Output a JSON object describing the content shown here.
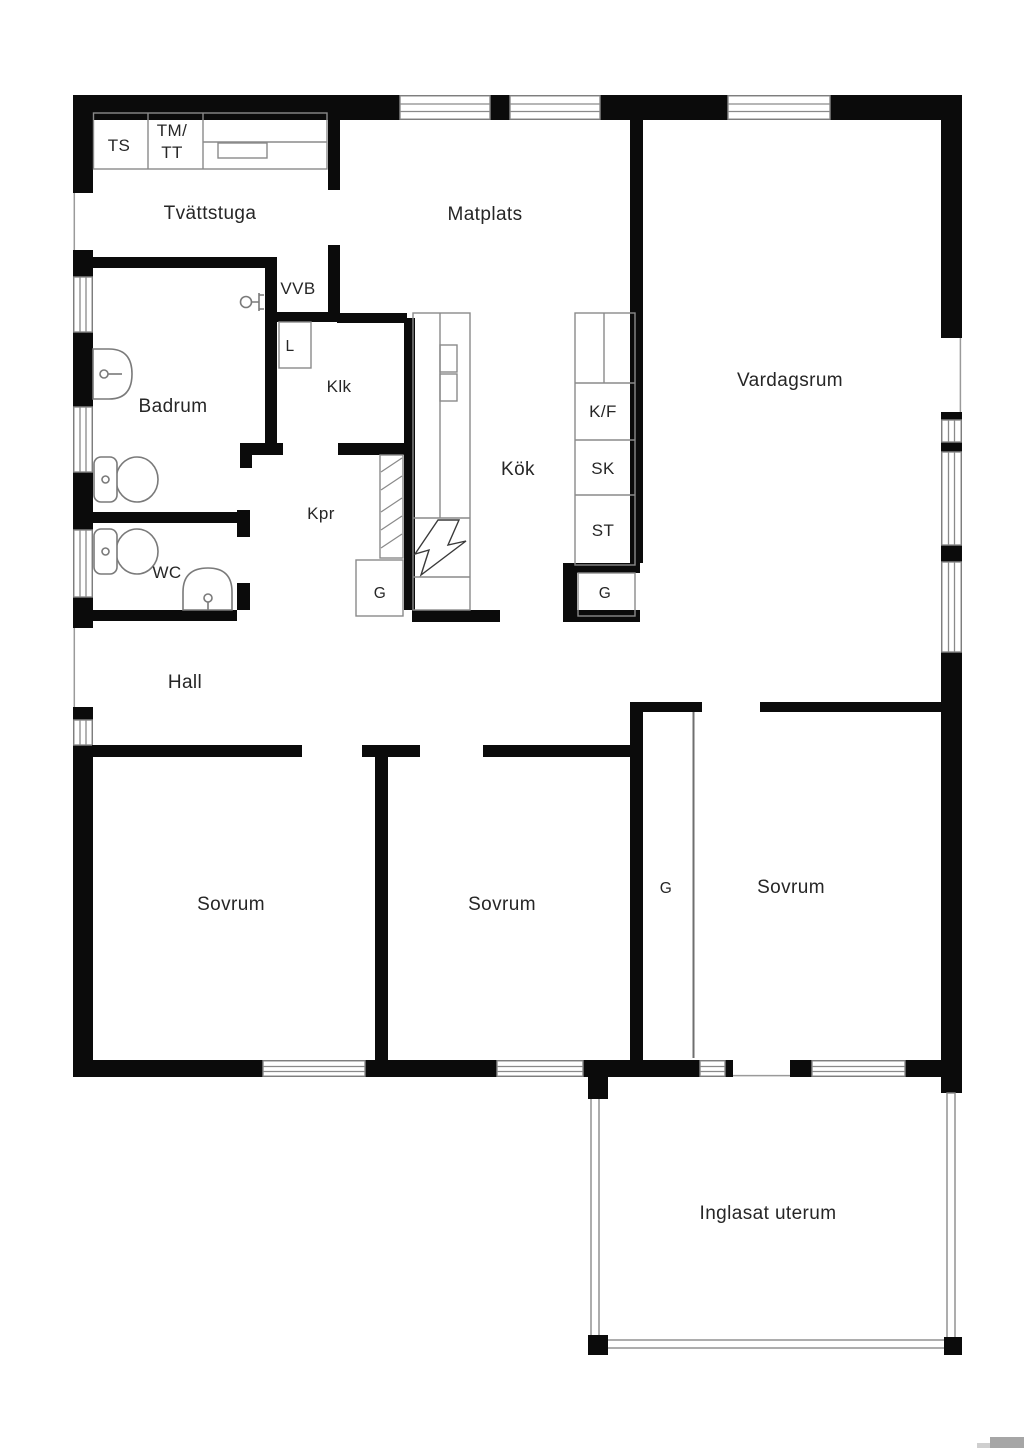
{
  "document": {
    "type": "floor-plan",
    "language": "sv",
    "background": "#ffffff"
  },
  "colors": {
    "wall": "#0b0b0b",
    "thin_line": "#8a8a8a",
    "text": "#262626",
    "watermark_dark": "#a6a6a6",
    "watermark_light": "#cfcfcf"
  },
  "labels": {
    "laundry_appliances": {
      "ts": "TS",
      "tm": "TM/",
      "tt": "TT"
    },
    "rooms": {
      "tvattstuga": "Tvättstuga",
      "matplats": "Matplats",
      "vardagsrum": "Vardagsrum",
      "badrum": "Badrum",
      "klk": "Klk",
      "kok": "Kök",
      "kpr": "Kpr",
      "wc": "WC",
      "hall": "Hall",
      "sovrum_1": "Sovrum",
      "sovrum_2": "Sovrum",
      "sovrum_3": "Sovrum",
      "inglasat_uterum": "Inglasat uterum"
    },
    "utilities": {
      "vvb": "VVB",
      "l": "L"
    },
    "kitchen_units": {
      "kf": "K/F",
      "sk": "SK",
      "st": "ST",
      "g_left": "G",
      "g_right": "G"
    },
    "wardrobes": {
      "g_bedroom": "G"
    }
  },
  "icons": {
    "toilet-icon": "tank+bowl outline",
    "washbasin-icon": "d-shape outline with tap",
    "corner-basin-icon": "dome outline with tap",
    "tap-icon": "small valve glyph",
    "stove-icon": "lightning bolt",
    "wardrobe-hatch-icon": "diagonal hatch strip",
    "sliding-door-icon": "thin line"
  }
}
